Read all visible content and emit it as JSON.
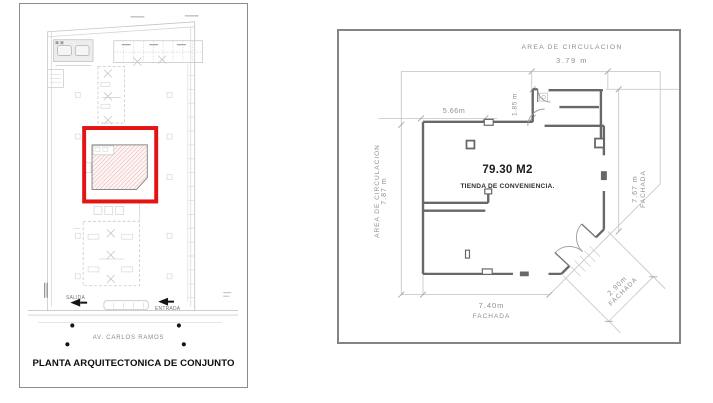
{
  "left_panel": {
    "title": "PLANTA ARQUITECTONICA DE CONJUNTO",
    "street": "AV. CARLOS RAMOS",
    "exit": "SALIDA",
    "entrance": "ENTRADA"
  },
  "right_panel": {
    "area": "79.30 M2",
    "name": "TIENDA DE CONVENIENCIA.",
    "top_circulation": "AREA DE CIRCULACION",
    "top_dim": "3.79 m",
    "left_circulation": "AREA DE CIRCULACION",
    "left_dim": "7.87 m",
    "right_dim": "7.67 m",
    "right_facade": "FACHADA",
    "bottom_dim": "7.40m",
    "bottom_facade": "FACHADA",
    "diag_dim": "2.90m",
    "diag_facade": "FACHADA",
    "inner_width": "5.66m",
    "inner_height": "1.85 m"
  },
  "colors": {
    "highlight": "#e41414",
    "hatch": "#e59f9f",
    "walls": "#686868",
    "dims": "#c2c2c2"
  }
}
